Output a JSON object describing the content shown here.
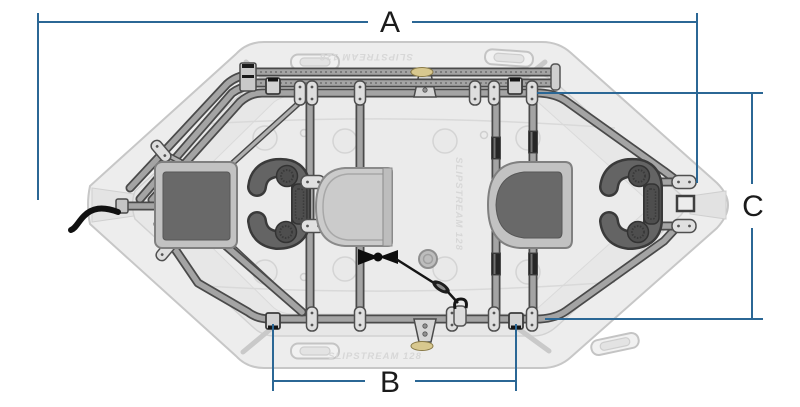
{
  "diagram": {
    "dimension_labels": {
      "a": "A",
      "b": "B",
      "c": "C"
    },
    "boat": {
      "model_text_top": "SLIPSTREAM 128",
      "model_text_middle": "SLIPSTREAM 128",
      "model_text_bottom": "SLIPSTREAM 128"
    },
    "colors": {
      "dimension_line": "#2b6795",
      "dimension_text": "#1b1b1b",
      "hull_fill": "#ededed",
      "hull_stroke": "#c7c7c7",
      "floor_fill": "#e7e7e7",
      "frame_tube_face": "#a4a4a4",
      "frame_tube_outline": "#4a4a4a",
      "seat_cushion_dark": "#696969",
      "seat_base_light": "#c2c2c2",
      "thigh_hook_dark": "#646464",
      "strap_black": "#151515",
      "oar_stop_tan": "#d8c88f"
    }
  }
}
